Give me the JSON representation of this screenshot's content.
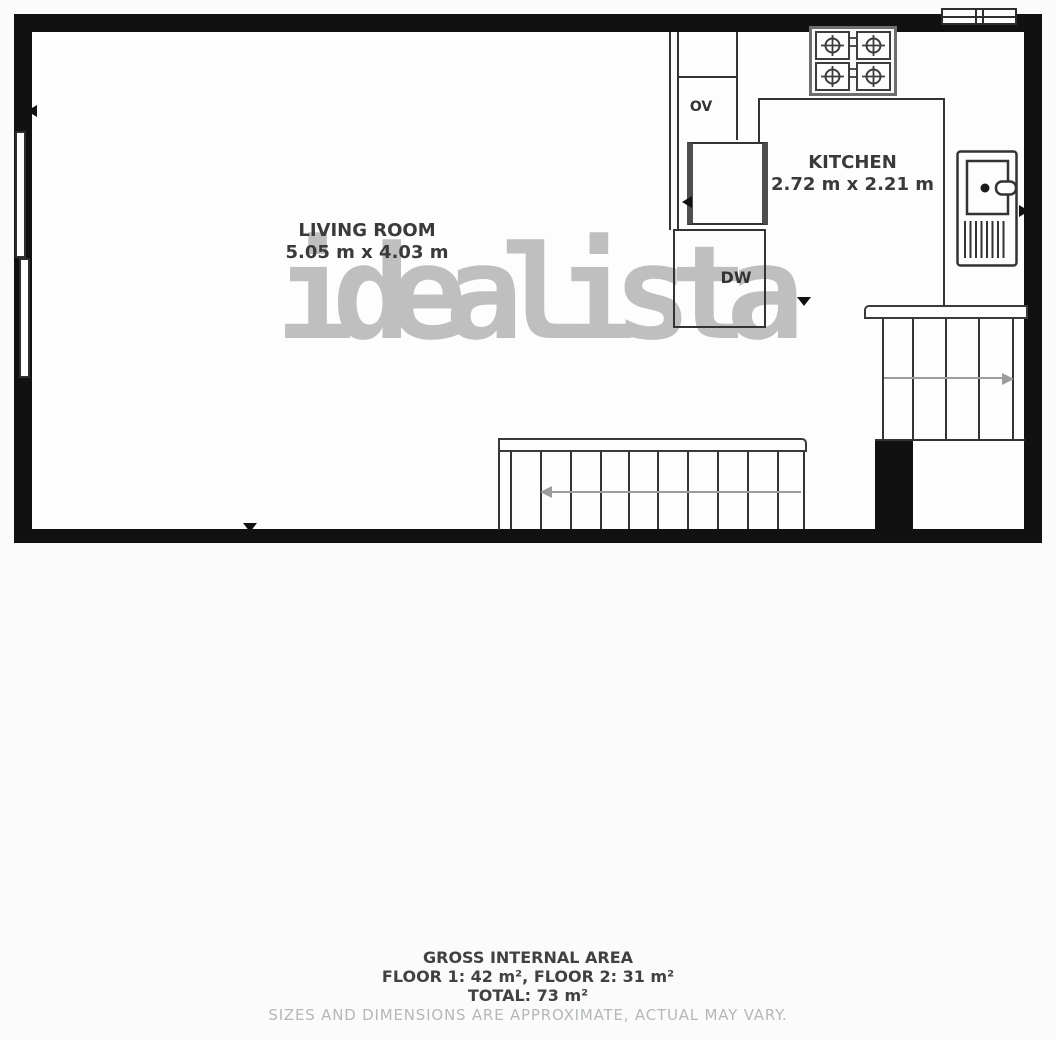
{
  "watermark": "idealista",
  "rooms": {
    "living_room": {
      "name": "LIVING ROOM",
      "dimensions": "5.05 m x 4.03 m"
    },
    "kitchen": {
      "name": "KITCHEN",
      "dimensions": "2.72 m x 2.21 m"
    }
  },
  "labels": {
    "oven": "OV",
    "dishwasher": "DW"
  },
  "footer": {
    "title": "GROSS INTERNAL AREA",
    "floors": "FLOOR 1: 42 m², FLOOR 2: 31 m²",
    "total": "TOTAL: 73 m²",
    "disclaimer": "SIZES AND DIMENSIONS ARE APPROXIMATE, ACTUAL MAY VARY."
  },
  "colors": {
    "wall": "#111111",
    "thin_line": "#333333",
    "stair_arrow": "#9c9c9c",
    "watermark": "#b0b0b0",
    "label_text": "#3a3a3a",
    "footer_text": "#414141",
    "disclaimer_text": "#b4b8bb",
    "background": "#fbfbfb"
  }
}
